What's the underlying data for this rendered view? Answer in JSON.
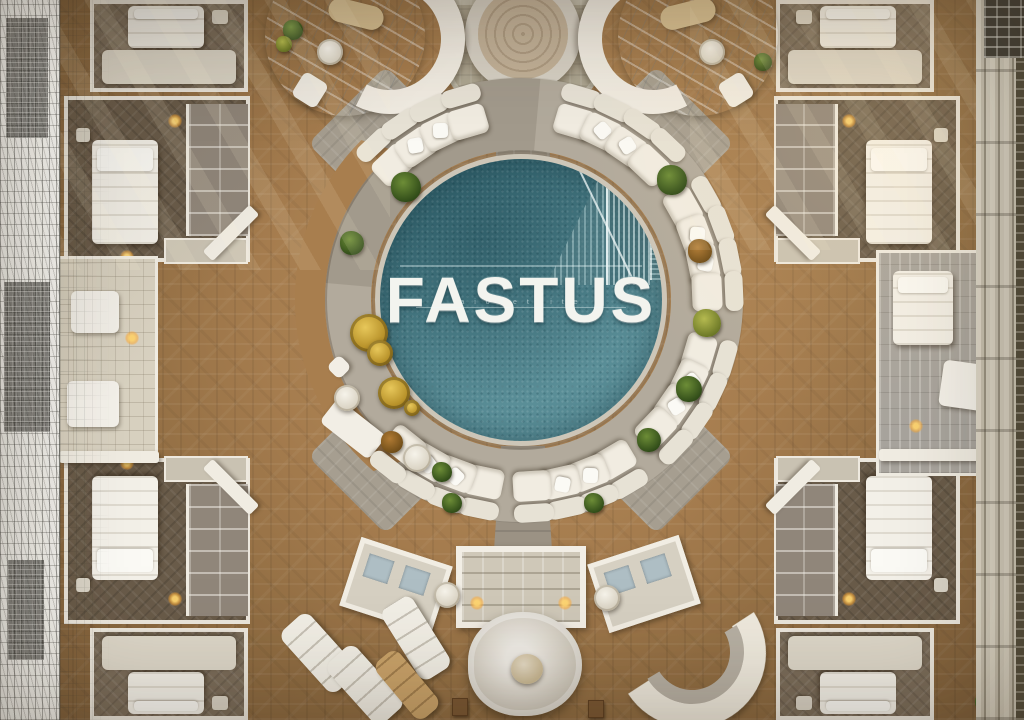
{
  "logo": {
    "text": "FASTUS",
    "tagline": "a i o x e t l i t e"
  },
  "palette": {
    "pool_teal": "#4d858f",
    "pool_teal_deep": "#3c6f7b",
    "pool_teal_light": "#79aeb4",
    "wood": "#9a744a",
    "wood_light": "#b08a55",
    "wood_dark": "#7c5e3a",
    "stone": "#b2aa9c",
    "stone_light": "#cdc6b7",
    "white_furniture": "#f1ece1",
    "white_bright": "#fbfaf5",
    "room_floor_dark": "#6a5b49",
    "room_floor_gray": "#7a6c5a",
    "marble": "#c9ced2",
    "gold": "#c7a233",
    "plant_green": "#5f7f2e",
    "plant_olive": "#a3742f",
    "lamp_glow": "#ffc763"
  }
}
